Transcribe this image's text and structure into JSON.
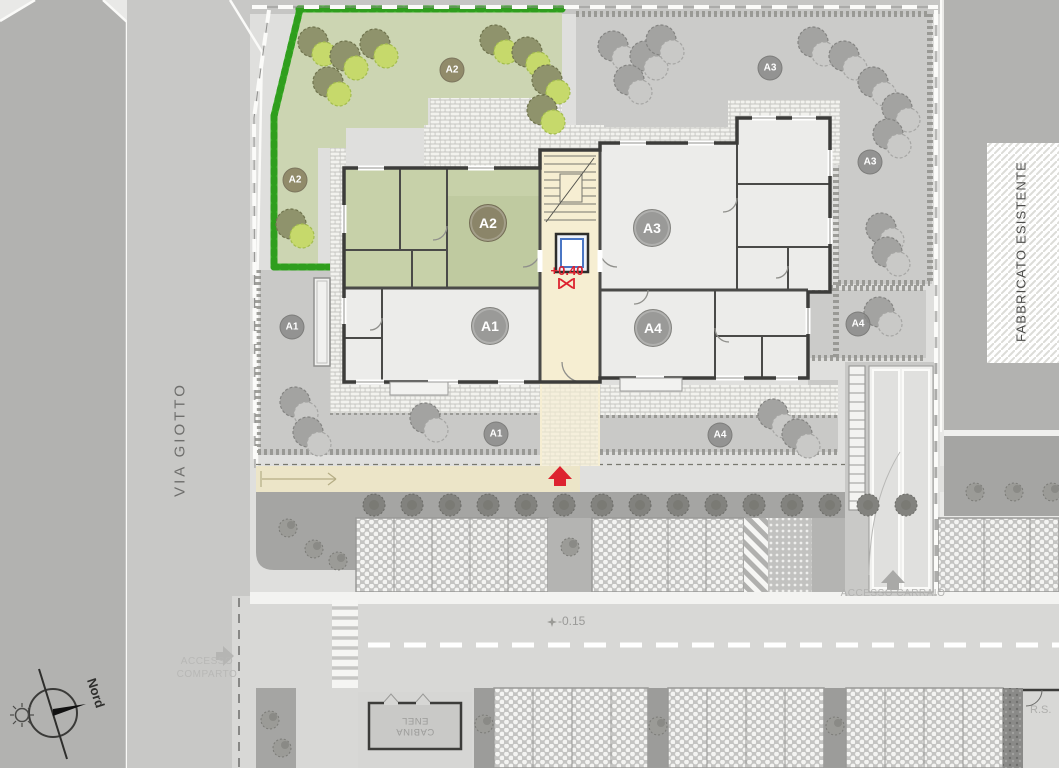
{
  "texts": {
    "street_name": "VIA GIOTTO",
    "existing_building": "FABBRICATO ESISTENTE",
    "compass_north": "Nord",
    "access_comparto_1": "ACCESSO",
    "access_comparto_2": "COMPARTO",
    "access_carraio": "ACCESSO CARRAIO",
    "cabina_1": "CABINA",
    "cabina_2": "ENEL",
    "waste_box": "R.S.",
    "level_entry": "+0.40",
    "level_road": "-0.15"
  },
  "unit_markers": [
    {
      "label": "A2",
      "kind": "garden",
      "theme": "green",
      "x": 452,
      "y": 70
    },
    {
      "label": "A2",
      "kind": "garden",
      "theme": "green",
      "x": 295,
      "y": 180
    },
    {
      "label": "A2",
      "kind": "unit",
      "theme": "green",
      "x": 488,
      "y": 223
    },
    {
      "label": "A3",
      "kind": "garden",
      "theme": "gray",
      "x": 770,
      "y": 68
    },
    {
      "label": "A3",
      "kind": "garden",
      "theme": "gray",
      "x": 870,
      "y": 162
    },
    {
      "label": "A3",
      "kind": "unit",
      "theme": "gray",
      "x": 652,
      "y": 228
    },
    {
      "label": "A1",
      "kind": "garden",
      "theme": "gray",
      "x": 292,
      "y": 327
    },
    {
      "label": "A1",
      "kind": "unit",
      "theme": "gray",
      "x": 490,
      "y": 326
    },
    {
      "label": "A4",
      "kind": "unit",
      "theme": "gray",
      "x": 653,
      "y": 328
    },
    {
      "label": "A4",
      "kind": "garden",
      "theme": "gray",
      "x": 858,
      "y": 324
    },
    {
      "label": "A1",
      "kind": "garden",
      "theme": "gray",
      "x": 496,
      "y": 434
    },
    {
      "label": "A4",
      "kind": "garden",
      "theme": "gray",
      "x": 720,
      "y": 435
    }
  ],
  "colors": {
    "accent_red": "#dd2330",
    "hedge_green": "#3fb22c",
    "garden_green": "#ccd5b2",
    "unit_room_green": "#c7d1a9",
    "elevator_blue": "#4a76c4",
    "wall_dark": "#3c3c3a",
    "core_cream": "#f6eed2",
    "existing_area_gray": "#b2b2b0"
  }
}
